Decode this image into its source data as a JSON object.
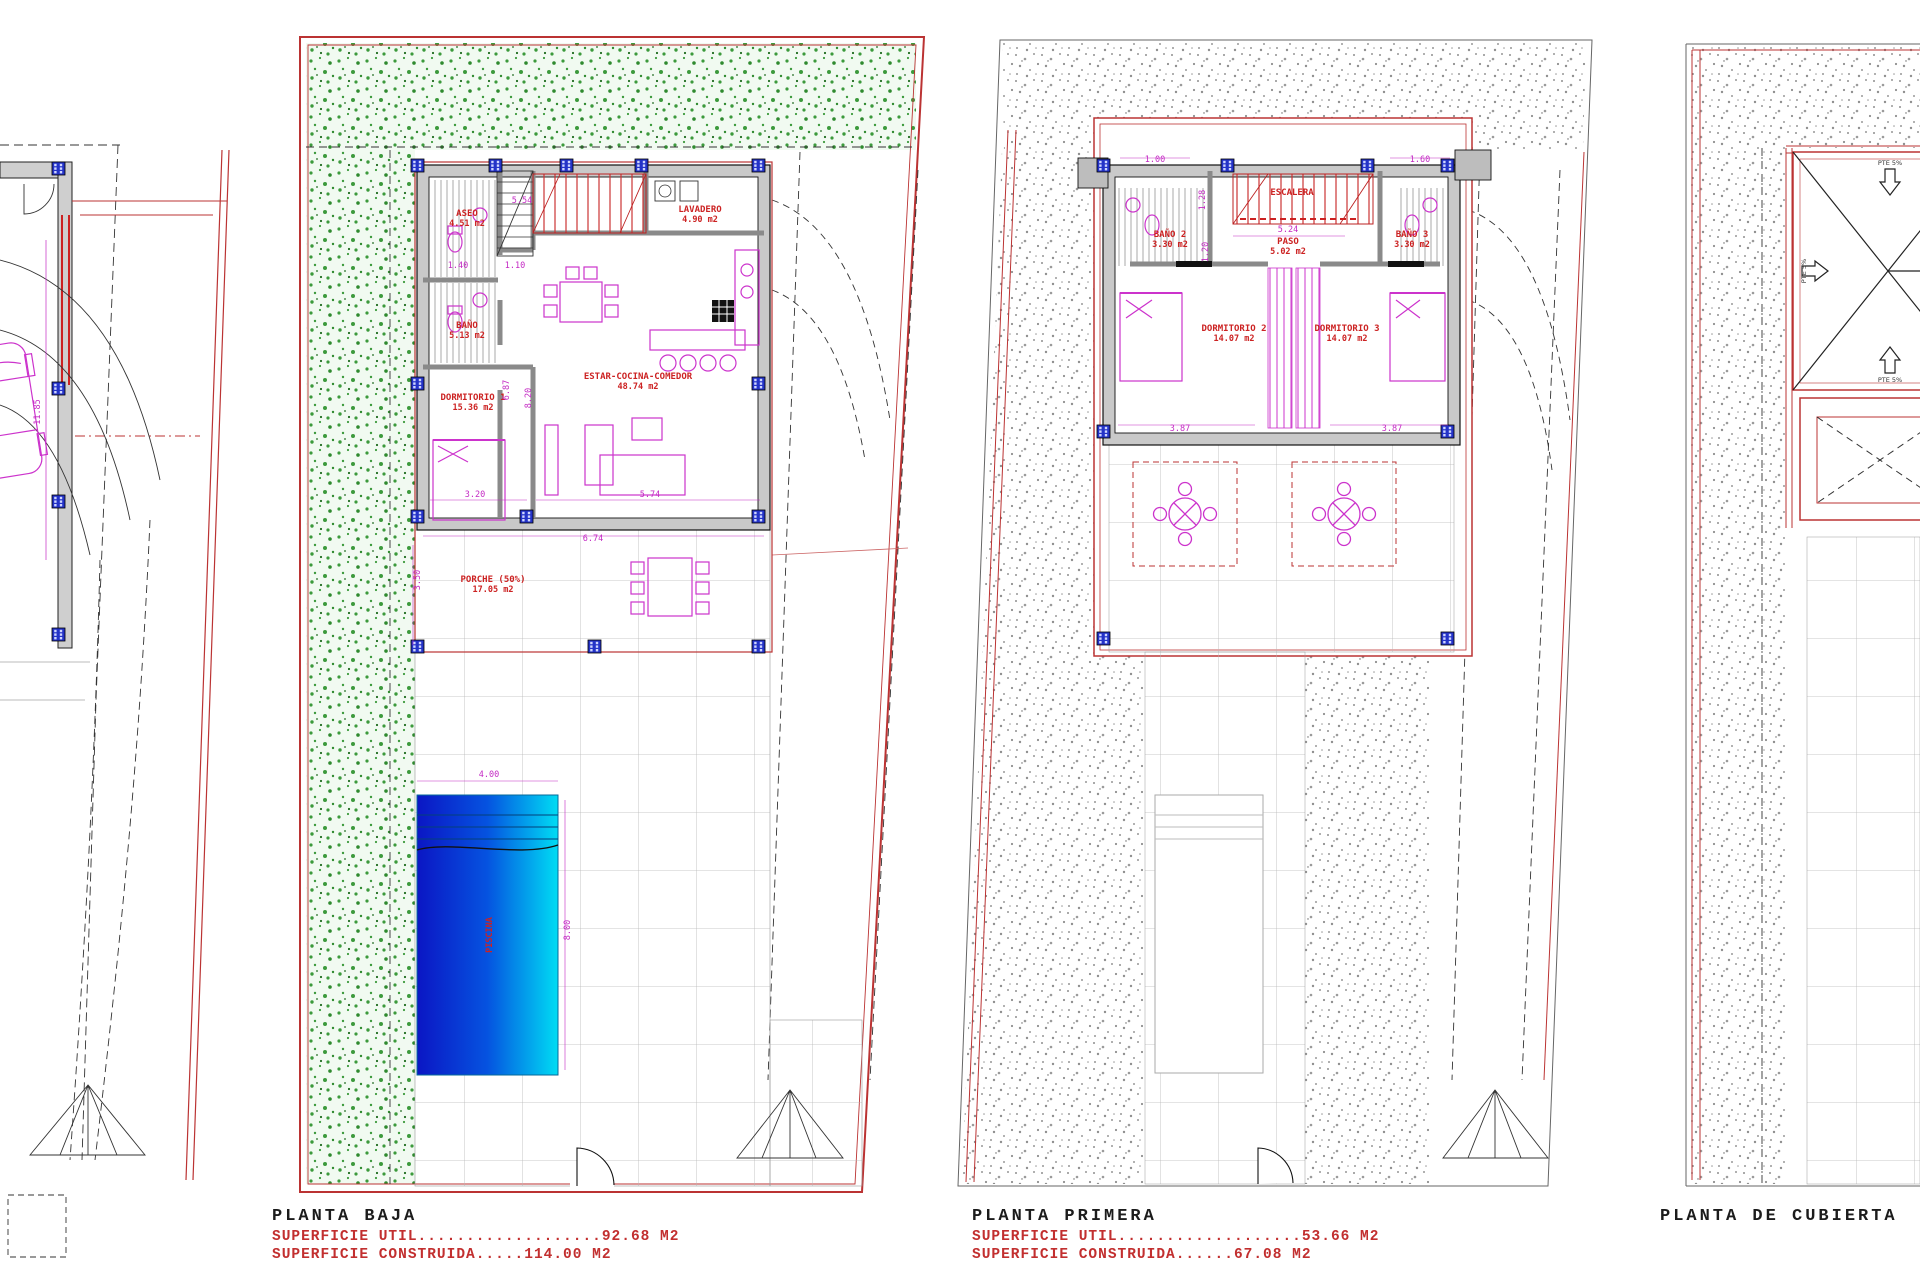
{
  "colors": {
    "boundary_red": "#bb3333",
    "label_red": "#cc2222",
    "superficie_red": "#c22f2f",
    "dimension_magenta": "#c42ac4",
    "furniture_magenta": "#cc33cc",
    "garden_green": "#3c9a3c",
    "stipple_gray": "#8f8f8f",
    "wall_gray": "#c9c9c9",
    "column_blue": "#2433c8",
    "pool_dark": "#0b16c4",
    "pool_light": "#00dcf4"
  },
  "site": {
    "dims": {
      "height": "11.85"
    }
  },
  "baja": {
    "title": "PLANTA BAJA",
    "sup_util": "SUPERFICIE UTIL...................92.68 M2",
    "sup_cons": "SUPERFICIE CONSTRUIDA.....114.00 M2",
    "rooms": [
      {
        "name": "ASEO",
        "area": "4.51 m2"
      },
      {
        "name": "BAÑO",
        "area": "5.13 m2"
      },
      {
        "name": "DORMITORIO 1",
        "area": "15.36 m2"
      },
      {
        "name": "ESTAR-COCINA-COMEDOR",
        "area": "48.74 m2"
      },
      {
        "name": "LAVADERO",
        "area": "4.90 m2"
      },
      {
        "name": "PORCHE (50%)",
        "area": "17.05 m2"
      }
    ],
    "pool_label": "PISCINA",
    "dims": {
      "top": "5.54",
      "w1": "1.40",
      "w2": "1.10",
      "living_h": "8.20",
      "hall_h": "6.87",
      "bed_w": "3.20",
      "living_w": "5.74",
      "total_w": "6.74",
      "porch_h": "3.50",
      "pool_w": "4.00",
      "pool_l": "8.00"
    }
  },
  "primera": {
    "title": "PLANTA PRIMERA",
    "sup_util": "SUPERFICIE UTIL...................53.66 M2",
    "sup_cons": "SUPERFICIE CONSTRUIDA......67.08 M2",
    "rooms": [
      {
        "name": "BAÑO 2",
        "area": "3.30 m2"
      },
      {
        "name": "BAÑO 3",
        "area": "3.30 m2"
      },
      {
        "name": "DORMITORIO 2",
        "area": "14.07 m2"
      },
      {
        "name": "DORMITORIO 3",
        "area": "14.07 m2"
      },
      {
        "name": "PASO",
        "area": "5.02 m2"
      },
      {
        "name": "ESCALERA",
        "area": ""
      }
    ],
    "dims": {
      "d1": "1.00",
      "d2": "1.60",
      "d3": "5.24",
      "d4": "1.28",
      "d5": "1.20",
      "bed1_w": "3.87",
      "bed2_w": "3.87"
    }
  },
  "cubierta": {
    "title": "PLANTA DE CUBIERTA",
    "slope1": "PTE 5%",
    "slope2": "PTE 5%",
    "slope3": "PTE 5%"
  }
}
